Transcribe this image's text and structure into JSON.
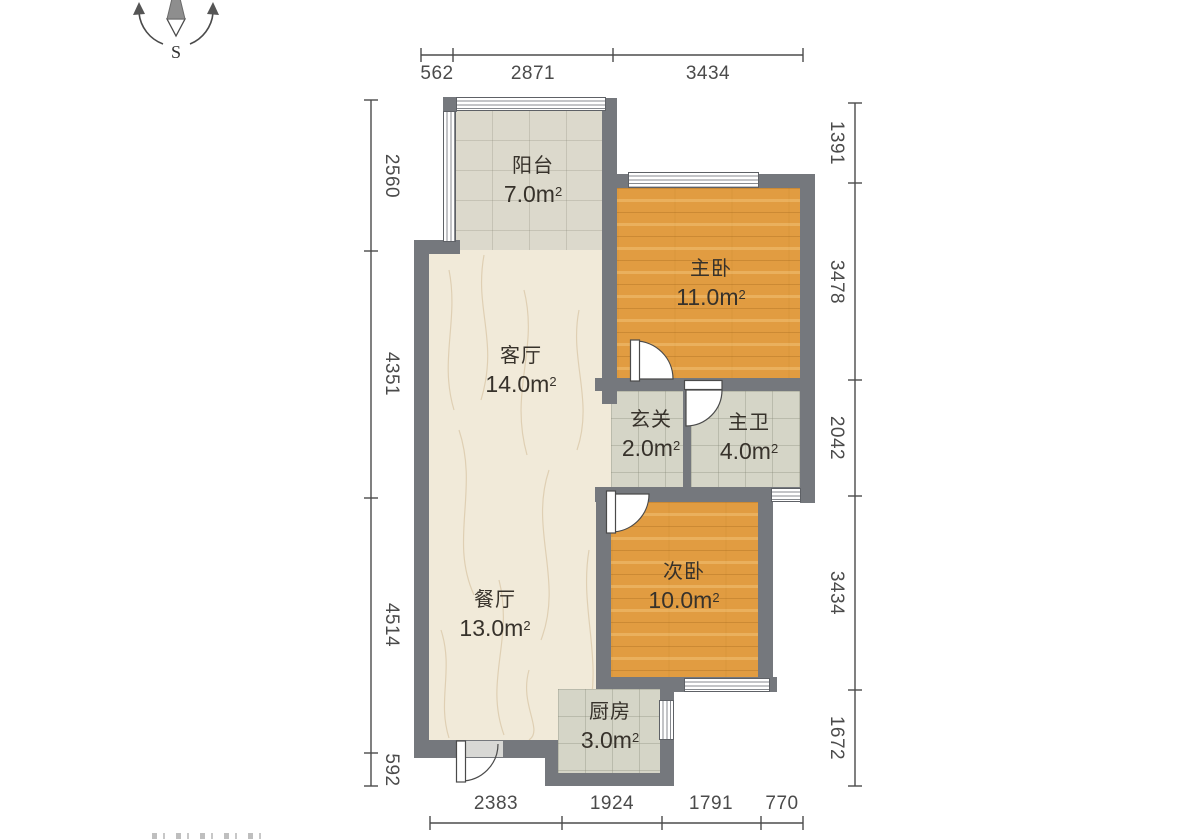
{
  "compass": {
    "south_label": "S"
  },
  "rooms": [
    {
      "key": "balcony",
      "name": "阳台",
      "area": "7.0m",
      "sup": "2"
    },
    {
      "key": "master-bedroom",
      "name": "主卧",
      "area": "11.0m",
      "sup": "2"
    },
    {
      "key": "living-room",
      "name": "客厅",
      "area": "14.0m",
      "sup": "2"
    },
    {
      "key": "hallway",
      "name": "玄关",
      "area": "2.0m",
      "sup": "2"
    },
    {
      "key": "master-bath",
      "name": "主卫",
      "area": "4.0m",
      "sup": "2"
    },
    {
      "key": "second-bedroom",
      "name": "次卧",
      "area": "10.0m",
      "sup": "2"
    },
    {
      "key": "dining-room",
      "name": "餐厅",
      "area": "13.0m",
      "sup": "2"
    },
    {
      "key": "kitchen",
      "name": "厨房",
      "area": "3.0m",
      "sup": "2"
    }
  ],
  "dimensions": {
    "top": [
      "562",
      "2871",
      "3434"
    ],
    "bottom": [
      "2383",
      "1924",
      "1791",
      "770"
    ],
    "left": [
      "2560",
      "4351",
      "4514",
      "592"
    ],
    "right": [
      "1391",
      "3478",
      "2042",
      "3434",
      "1672"
    ]
  },
  "colors": {
    "wall": "#75787d",
    "wood_floor": "#e19c41",
    "tile_floor": "#d5d5c7",
    "balcony_floor": "#dcd9cc",
    "living_floor": "#f1ead9",
    "dimension_text": "#4b4b4b",
    "label_text": "#37322b"
  }
}
